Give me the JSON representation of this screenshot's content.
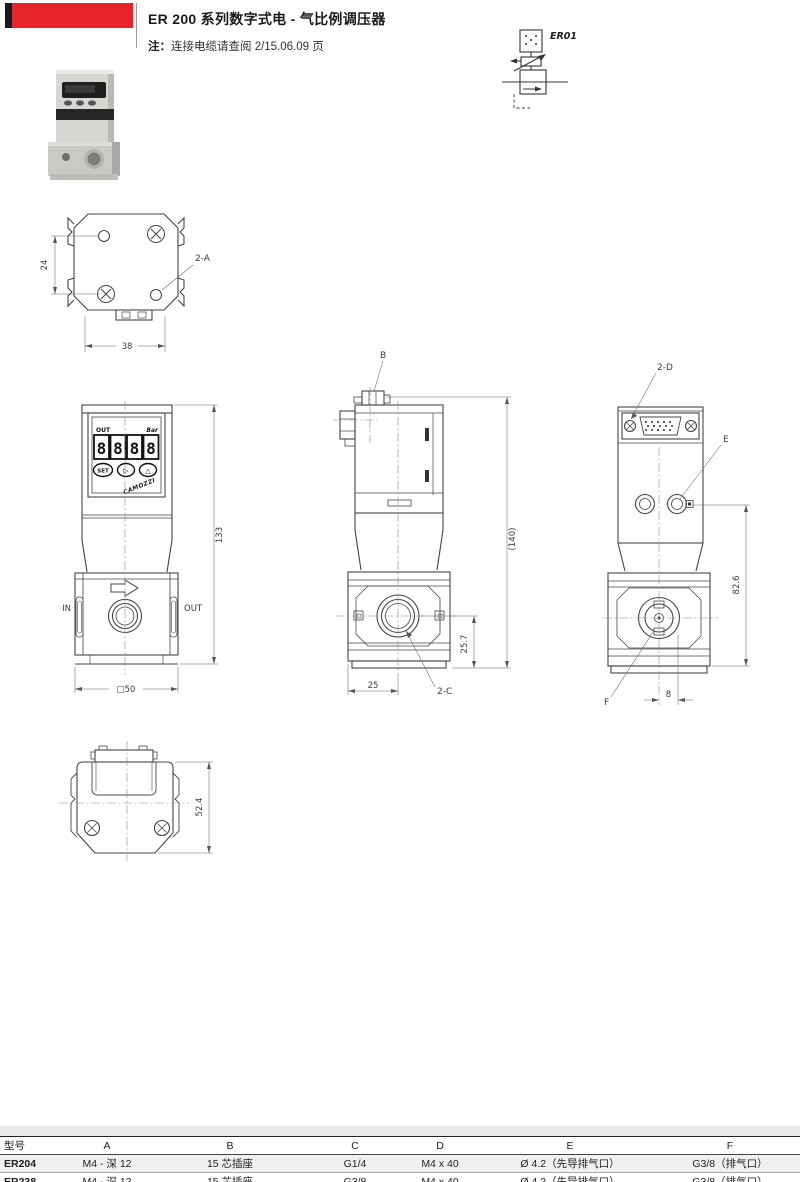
{
  "page": {
    "title": "ER 200 系列数字式电 - 气比例调压器",
    "note_label": "注：",
    "note_text": "连接电缆请查阅 2/15.06.09 页",
    "accent_red": "#e7232b"
  },
  "schematic": {
    "label": "ER01"
  },
  "views": {
    "top": {
      "dim_height": "24",
      "dim_width": "38",
      "callout": "2-A"
    },
    "front": {
      "display": {
        "out": "OUT",
        "unit": "Bar",
        "digits": "8888",
        "btn_set": "SET",
        "btn_next": "▷",
        "btn_up": "△",
        "brand": "CAMOZZI"
      },
      "label_in": "IN",
      "label_out": "OUT",
      "dim_height": "133",
      "dim_width": "□50"
    },
    "side": {
      "callout_top": "B",
      "dim_height": "(140)",
      "dim_port_height": "25.7",
      "dim_width": "25",
      "callout_port": "2-C"
    },
    "rear": {
      "callout_connector": "2-D",
      "callout_pilot": "E",
      "dim_height": "82.6",
      "callout_exhaust": "F",
      "dim_offset": "8"
    },
    "bottom": {
      "dim_height": "52.4"
    }
  },
  "table": {
    "headers": [
      "型号",
      "A",
      "B",
      "C",
      "D",
      "E",
      "F"
    ],
    "rows": [
      [
        "ER204",
        "M4 - 深 12",
        "15 芯插座",
        "G1/4",
        "M4 x 40",
        "Ø 4.2（先导排气口）",
        "G3/8（排气口）"
      ],
      [
        "ER238",
        "M4 - 深 12",
        "15 芯插座",
        "G3/8",
        "M4 x 40",
        "Ø 4.2（先导排气口）",
        "G3/8（排气口）"
      ]
    ]
  }
}
